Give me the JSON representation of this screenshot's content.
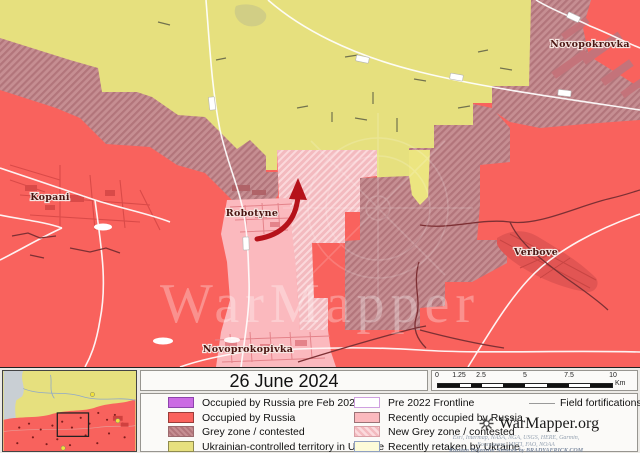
{
  "map": {
    "labels": {
      "kopani": "Kopani",
      "robotyne": "Robotyne",
      "novoprokopivka": "Novoprokopivka",
      "verbove": "Verbove",
      "novopokrovka": "Novopokrovka"
    },
    "watermark": "WarMapper"
  },
  "panel": {
    "date": "26 June 2024",
    "legend": {
      "column1": [
        {
          "label": "Occupied by Russia pre Feb 2022",
          "color": "#cb6be3",
          "style": "solid"
        },
        {
          "label": "Occupied by Russia",
          "color": "#f9625d",
          "style": "solid"
        },
        {
          "label": "Grey zone / contested",
          "color": "#c68e92",
          "style": "hatched"
        },
        {
          "label": "Ukrainian-controlled territory in Ukraine",
          "color": "#e7e07f",
          "style": "solid"
        }
      ],
      "column2": [
        {
          "label": "Pre 2022 Frontline",
          "color": "#ffffff",
          "style": "outline"
        },
        {
          "label": "Recently occupied by Russia",
          "color": "#fbb9be",
          "style": "solid"
        },
        {
          "label": "New Grey zone / contested",
          "color": "#f3babf",
          "style": "hatched"
        },
        {
          "label": "Recently retaken by Ukraine",
          "color": "#fdfbd9",
          "style": "solid"
        }
      ],
      "field_fortifications_label": "Field fortifications"
    },
    "scalebar": {
      "ticks": [
        "0",
        "1.25",
        "2.5",
        "5",
        "7.5",
        "10"
      ],
      "unit": "Km"
    },
    "branding": {
      "site": "WarMapper.org",
      "attribution1": "Esri, Intermap, NASA, NGA, USGS, HERE, Garmin,",
      "attribution2": "Foursquare, METI, FAO, NOAA",
      "attribution3": "Russian Defensive Network by BRADYAFRICK.COM"
    }
  },
  "colors": {
    "ukrainian_controlled": "#e6e07e",
    "occupied_by_russia": "#f9625d",
    "occupied_pre_feb_2022": "#cb6be3",
    "grey_zone": "#c68e92",
    "recently_occupied": "#fbb9be",
    "new_grey_zone": "#f3babf",
    "recently_retaken": "#fdfbd9",
    "advance_arrow": "#b5121a",
    "fortification_line": "#7d3034",
    "road": "#ffffff"
  }
}
